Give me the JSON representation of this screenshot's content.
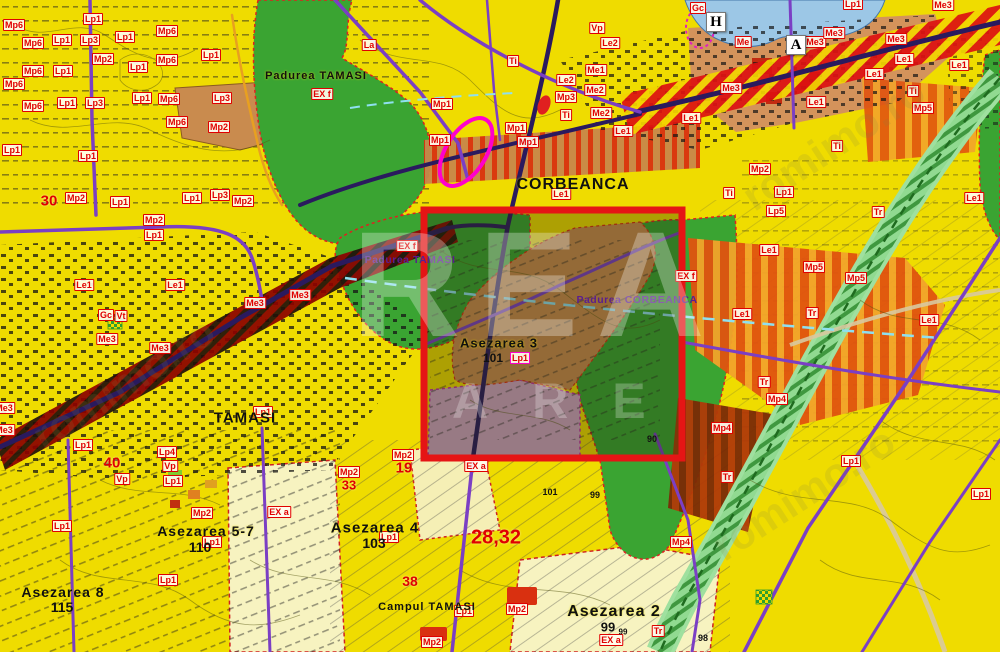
{
  "map": {
    "title": "Cadastral zoning map – Corbeanca / Tamasi",
    "watermark": {
      "big": "REA",
      "row2": "ARE",
      "diag": "romimo.ro"
    },
    "selection": {
      "x": 424,
      "y": 210,
      "w": 258,
      "h": 248
    },
    "markers": [
      {
        "t": "H",
        "x": 716,
        "y": 22
      },
      {
        "t": "A",
        "x": 796,
        "y": 45
      }
    ],
    "places": [
      {
        "t": "CORBEANCA",
        "x": 573,
        "y": 185,
        "s": 16
      },
      {
        "t": "TAMASI",
        "x": 245,
        "y": 418,
        "s": 15
      },
      {
        "t": "Asezarea 5-7",
        "x": 206,
        "y": 531,
        "s": 14
      },
      {
        "t": "Asezarea 8",
        "x": 63,
        "y": 592,
        "s": 14
      },
      {
        "t": "Asezarea 4",
        "x": 375,
        "y": 528,
        "s": 15
      },
      {
        "t": "Asezarea 2",
        "x": 614,
        "y": 612,
        "s": 16
      },
      {
        "t": "Asezarea 3",
        "x": 499,
        "y": 343,
        "s": 13
      },
      {
        "t": "Campul TAMASI",
        "x": 427,
        "y": 607,
        "s": 11
      },
      {
        "t": "Padurea TAMASI",
        "x": 316,
        "y": 76,
        "s": 11
      }
    ],
    "forest_labels": [
      {
        "t": "Padurea TAMASI",
        "x": 410,
        "y": 260
      },
      {
        "t": "Padurea CORBEANCA",
        "x": 637,
        "y": 300
      }
    ],
    "red_numbers": [
      {
        "t": "30",
        "x": 49,
        "y": 201,
        "s": 15
      },
      {
        "t": "40",
        "x": 112,
        "y": 463,
        "s": 15
      },
      {
        "t": "19",
        "x": 404,
        "y": 468,
        "s": 15
      },
      {
        "t": "38",
        "x": 410,
        "y": 581,
        "s": 14
      },
      {
        "t": "33",
        "x": 349,
        "y": 485,
        "s": 13
      },
      {
        "t": "28,32",
        "x": 496,
        "y": 538,
        "s": 20
      }
    ],
    "black_numbers": [
      {
        "t": "110",
        "x": 200,
        "y": 547,
        "s": 14
      },
      {
        "t": "115",
        "x": 62,
        "y": 607,
        "s": 14
      },
      {
        "t": "103",
        "x": 374,
        "y": 543,
        "s": 14
      },
      {
        "t": "101",
        "x": 493,
        "y": 358,
        "s": 12
      },
      {
        "t": "101",
        "x": 550,
        "y": 492,
        "s": 9
      },
      {
        "t": "99",
        "x": 595,
        "y": 495,
        "s": 9
      },
      {
        "t": "99",
        "x": 608,
        "y": 627,
        "s": 13
      },
      {
        "t": "99",
        "x": 623,
        "y": 632,
        "s": 8
      },
      {
        "t": "98",
        "x": 703,
        "y": 638,
        "s": 9
      },
      {
        "t": "90",
        "x": 652,
        "y": 439,
        "s": 9
      }
    ],
    "magenta_labels": [
      {
        "t": "Lp1",
        "x": 520,
        "y": 358
      }
    ],
    "zone_labels": [
      {
        "t": "Mp6",
        "x": 14,
        "y": 25
      },
      {
        "t": "Mp6",
        "x": 33,
        "y": 43
      },
      {
        "t": "Mp6",
        "x": 33,
        "y": 71
      },
      {
        "t": "Mp6",
        "x": 14,
        "y": 84
      },
      {
        "t": "Mp6",
        "x": 33,
        "y": 106
      },
      {
        "t": "Mp6",
        "x": 167,
        "y": 31
      },
      {
        "t": "Mp6",
        "x": 167,
        "y": 60
      },
      {
        "t": "Mp6",
        "x": 169,
        "y": 99
      },
      {
        "t": "Mp6",
        "x": 177,
        "y": 122
      },
      {
        "t": "Lp1",
        "x": 93,
        "y": 19
      },
      {
        "t": "Lp1",
        "x": 62,
        "y": 40
      },
      {
        "t": "Lp1",
        "x": 125,
        "y": 37
      },
      {
        "t": "Lp1",
        "x": 63,
        "y": 71
      },
      {
        "t": "Lp1",
        "x": 138,
        "y": 67
      },
      {
        "t": "Lp1",
        "x": 211,
        "y": 55
      },
      {
        "t": "Lp1",
        "x": 67,
        "y": 103
      },
      {
        "t": "Lp1",
        "x": 142,
        "y": 98
      },
      {
        "t": "Lp1",
        "x": 12,
        "y": 150
      },
      {
        "t": "Lp1",
        "x": 88,
        "y": 156
      },
      {
        "t": "Lp1",
        "x": 120,
        "y": 202
      },
      {
        "t": "Lp1",
        "x": 192,
        "y": 198
      },
      {
        "t": "Lp1",
        "x": 154,
        "y": 235
      },
      {
        "t": "Lp1",
        "x": 263,
        "y": 412
      },
      {
        "t": "Lp1",
        "x": 83,
        "y": 445
      },
      {
        "t": "Lp1",
        "x": 173,
        "y": 481
      },
      {
        "t": "Lp1",
        "x": 62,
        "y": 526
      },
      {
        "t": "Lp1",
        "x": 212,
        "y": 542
      },
      {
        "t": "Lp1",
        "x": 168,
        "y": 580
      },
      {
        "t": "Lp1",
        "x": 389,
        "y": 537
      },
      {
        "t": "Lp1",
        "x": 464,
        "y": 611
      },
      {
        "t": "Lp1",
        "x": 853,
        "y": 4
      },
      {
        "t": "Lp1",
        "x": 784,
        "y": 192
      },
      {
        "t": "Lp1",
        "x": 851,
        "y": 461
      },
      {
        "t": "Lp1",
        "x": 981,
        "y": 494
      },
      {
        "t": "Lp3",
        "x": 90,
        "y": 40
      },
      {
        "t": "Lp3",
        "x": 95,
        "y": 103
      },
      {
        "t": "Lp3",
        "x": 222,
        "y": 98
      },
      {
        "t": "Lp3",
        "x": 220,
        "y": 195
      },
      {
        "t": "Mp2",
        "x": 103,
        "y": 59
      },
      {
        "t": "Mp2",
        "x": 219,
        "y": 127
      },
      {
        "t": "Mp2",
        "x": 76,
        "y": 198
      },
      {
        "t": "Mp2",
        "x": 243,
        "y": 201
      },
      {
        "t": "Mp2",
        "x": 154,
        "y": 220
      },
      {
        "t": "Mp2",
        "x": 349,
        "y": 472
      },
      {
        "t": "Mp2",
        "x": 403,
        "y": 455
      },
      {
        "t": "Mp2",
        "x": 202,
        "y": 513
      },
      {
        "t": "Mp2",
        "x": 517,
        "y": 609
      },
      {
        "t": "Mp2",
        "x": 432,
        "y": 642
      },
      {
        "t": "Mp2",
        "x": 760,
        "y": 169
      },
      {
        "t": "La",
        "x": 369,
        "y": 45
      },
      {
        "t": "Ti",
        "x": 513,
        "y": 61
      },
      {
        "t": "Ti",
        "x": 566,
        "y": 115
      },
      {
        "t": "Ti",
        "x": 913,
        "y": 91
      },
      {
        "t": "Ti",
        "x": 837,
        "y": 146
      },
      {
        "t": "Ti",
        "x": 729,
        "y": 193
      },
      {
        "t": "Vp",
        "x": 597,
        "y": 28
      },
      {
        "t": "Vp",
        "x": 170,
        "y": 466
      },
      {
        "t": "Vp",
        "x": 122,
        "y": 479
      },
      {
        "t": "Le2",
        "x": 610,
        "y": 43
      },
      {
        "t": "Le2",
        "x": 566,
        "y": 80
      },
      {
        "t": "Me1",
        "x": 596,
        "y": 70
      },
      {
        "t": "Me2",
        "x": 595,
        "y": 90
      },
      {
        "t": "Me2",
        "x": 601,
        "y": 113
      },
      {
        "t": "Mp3",
        "x": 566,
        "y": 97
      },
      {
        "t": "Le1",
        "x": 623,
        "y": 131
      },
      {
        "t": "Le1",
        "x": 561,
        "y": 194
      },
      {
        "t": "Le1",
        "x": 904,
        "y": 59
      },
      {
        "t": "Le1",
        "x": 874,
        "y": 74
      },
      {
        "t": "Le1",
        "x": 816,
        "y": 102
      },
      {
        "t": "Le1",
        "x": 691,
        "y": 118
      },
      {
        "t": "Le1",
        "x": 959,
        "y": 65
      },
      {
        "t": "Le1",
        "x": 84,
        "y": 285
      },
      {
        "t": "Le1",
        "x": 175,
        "y": 285
      },
      {
        "t": "Le1",
        "x": 769,
        "y": 250
      },
      {
        "t": "Le1",
        "x": 742,
        "y": 314
      },
      {
        "t": "Le1",
        "x": 929,
        "y": 320
      },
      {
        "t": "Le1",
        "x": 974,
        "y": 198
      },
      {
        "t": "Me3",
        "x": 815,
        "y": 42
      },
      {
        "t": "Me3",
        "x": 834,
        "y": 33
      },
      {
        "t": "Me3",
        "x": 896,
        "y": 39
      },
      {
        "t": "Me3",
        "x": 943,
        "y": 5
      },
      {
        "t": "Me3",
        "x": 731,
        "y": 88
      },
      {
        "t": "Me3",
        "x": 300,
        "y": 295
      },
      {
        "t": "Me3",
        "x": 255,
        "y": 303
      },
      {
        "t": "Me3",
        "x": 107,
        "y": 339
      },
      {
        "t": "Me3",
        "x": 160,
        "y": 348
      },
      {
        "t": "Me3",
        "x": 4,
        "y": 408
      },
      {
        "t": "Me3",
        "x": 4,
        "y": 430
      },
      {
        "t": "Me",
        "x": 743,
        "y": 42
      },
      {
        "t": "Gc",
        "x": 698,
        "y": 8
      },
      {
        "t": "Gc",
        "x": 106,
        "y": 315
      },
      {
        "t": "Vt",
        "x": 121,
        "y": 316
      },
      {
        "t": "Mp1",
        "x": 442,
        "y": 104
      },
      {
        "t": "Mp1",
        "x": 440,
        "y": 140
      },
      {
        "t": "Mp1",
        "x": 516,
        "y": 128
      },
      {
        "t": "Mp1",
        "x": 528,
        "y": 142
      },
      {
        "t": "Mp5",
        "x": 923,
        "y": 108
      },
      {
        "t": "Mp5",
        "x": 814,
        "y": 267
      },
      {
        "t": "Mp5",
        "x": 856,
        "y": 278
      },
      {
        "t": "Mp4",
        "x": 777,
        "y": 399
      },
      {
        "t": "Mp4",
        "x": 722,
        "y": 428
      },
      {
        "t": "Mp4",
        "x": 681,
        "y": 542
      },
      {
        "t": "Lp5",
        "x": 776,
        "y": 211
      },
      {
        "t": "Lp4",
        "x": 167,
        "y": 452
      },
      {
        "t": "Tr",
        "x": 878,
        "y": 212
      },
      {
        "t": "Tr",
        "x": 812,
        "y": 313
      },
      {
        "t": "Tr",
        "x": 764,
        "y": 382
      },
      {
        "t": "Tr",
        "x": 727,
        "y": 477
      },
      {
        "t": "Tr",
        "x": 658,
        "y": 631
      },
      {
        "t": "EX f",
        "x": 322,
        "y": 94
      },
      {
        "t": "EX f",
        "x": 407,
        "y": 246
      },
      {
        "t": "EX f",
        "x": 686,
        "y": 276
      },
      {
        "t": "EX a",
        "x": 279,
        "y": 512
      },
      {
        "t": "EX a",
        "x": 476,
        "y": 466
      },
      {
        "t": "EX a",
        "x": 611,
        "y": 640
      }
    ],
    "colors": {
      "base_yellow": "#EFDC00",
      "pale_yellow": "#F7F3C0",
      "forest_green": "#3AA432",
      "corridor_green": "#8FD98F",
      "water_blue": "#9CC7E6",
      "settlement_tan": "#C98B4E",
      "pink_zone": "#CFA3C0",
      "road_purple": "#7B3FC4",
      "road_navy": "#2A1A5E",
      "stripe_orange": "#E0530F",
      "hatch_red": "#DD1111",
      "highlight_red": "#E51515",
      "label_red": "#E00000"
    }
  }
}
